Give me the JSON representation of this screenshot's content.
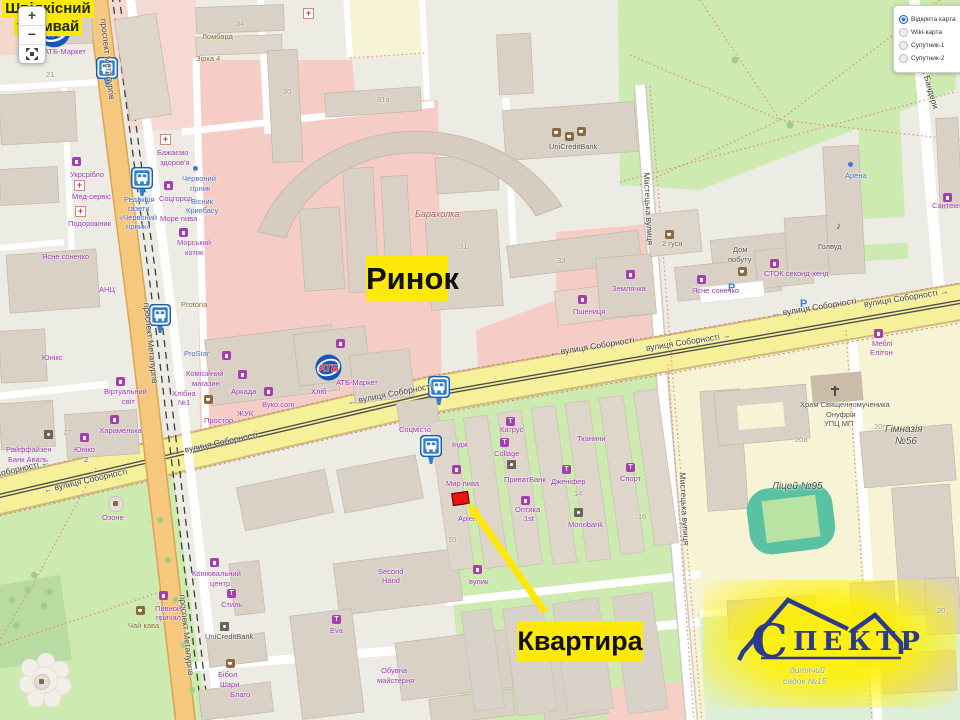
{
  "controls": {
    "zoom_in": "+",
    "zoom_out": "−"
  },
  "layers": {
    "options": [
      {
        "label": "Відкрита карта",
        "selected": true
      },
      {
        "label": "Wiki-карта",
        "selected": false
      },
      {
        "label": "Супутник-1",
        "selected": false
      },
      {
        "label": "Супутник-2",
        "selected": false
      }
    ]
  },
  "annotations": {
    "market": "Ринок",
    "apartment": "Квартира",
    "tram_line1": "Швідкісний",
    "tram_line2": "трамвай"
  },
  "logo": {
    "initial": "С",
    "rest": "ПЕКТР"
  },
  "colors": {
    "annotation_bg": "#ffe90a",
    "marker_red": "#ee1212",
    "street_major": "#f6f09b",
    "street_avenue": "#f6c87e",
    "park": "#cdeab0",
    "market_zone": "#f6cdc6",
    "school_zone": "#f7f4d6"
  },
  "map_labels": [
    {
      "t": "вулиця Соборності ←",
      "x": -34,
      "y": 477,
      "c": "street",
      "r": -13
    },
    {
      "t": "← вулиця Соборності",
      "x": 44,
      "y": 486,
      "c": "street",
      "r": -13
    },
    {
      "t": "← вулиця Соборності",
      "x": 174,
      "y": 448,
      "c": "street",
      "r": -12
    },
    {
      "t": "← вулиця Соборності",
      "x": 348,
      "y": 398,
      "c": "street",
      "r": -11
    },
    {
      "t": "← вулиця Соборності",
      "x": 550,
      "y": 349,
      "c": "street",
      "r": -9
    },
    {
      "t": "вулиця Соборності →",
      "x": 646,
      "y": 344,
      "c": "street",
      "r": -9
    },
    {
      "t": "← вулиця Соборності",
      "x": 772,
      "y": 310,
      "c": "street",
      "r": -9
    },
    {
      "t": "вулиця Соборності →",
      "x": 864,
      "y": 300,
      "c": "street",
      "r": -9
    },
    {
      "t": "проспект Металургів",
      "x": 103,
      "y": 14,
      "c": "street",
      "r": 84
    },
    {
      "t": "проспект Металургів",
      "x": 146,
      "y": 298,
      "c": "street",
      "r": 84
    },
    {
      "t": "проспект Металургів",
      "x": 182,
      "y": 590,
      "c": "street",
      "r": 84
    },
    {
      "t": "Мистецька вулиця",
      "x": 646,
      "y": 168,
      "c": "street",
      "r": 87
    },
    {
      "t": "Мистецька вулиця",
      "x": 682,
      "y": 468,
      "c": "street",
      "r": 87
    },
    {
      "t": "вулиця Степана Бандери",
      "x": 908,
      "y": 8,
      "c": "street",
      "r": 74
    },
    {
      "t": "Альфа-",
      "x": 48,
      "y": 6,
      "c": "shop"
    },
    {
      "t": "АТБ-Маркет",
      "x": 44,
      "y": 48,
      "c": "shop"
    },
    {
      "t": "Ломбард",
      "x": 202,
      "y": 33,
      "c": "amen"
    },
    {
      "t": "Зірка 4",
      "x": 196,
      "y": 55,
      "c": "amen"
    },
    {
      "t": "Бажаємо",
      "x": 157,
      "y": 149,
      "c": "shop"
    },
    {
      "t": "здоров'я",
      "x": 160,
      "y": 159,
      "c": "shop"
    },
    {
      "t": "Укрсрібло",
      "x": 70,
      "y": 171,
      "c": "shop"
    },
    {
      "t": "Мед-сервіс",
      "x": 72,
      "y": 193,
      "c": "shop"
    },
    {
      "t": "Подорожник",
      "x": 68,
      "y": 220,
      "c": "shop"
    },
    {
      "t": "Червоний",
      "x": 182,
      "y": 175,
      "c": "info"
    },
    {
      "t": "гірник",
      "x": 190,
      "y": 185,
      "c": "info"
    },
    {
      "t": "Редакція",
      "x": 124,
      "y": 196,
      "c": "info"
    },
    {
      "t": "газети",
      "x": 128,
      "y": 205,
      "c": "info"
    },
    {
      "t": "«Червоний",
      "x": 119,
      "y": 214,
      "c": "info"
    },
    {
      "t": "гірник»",
      "x": 126,
      "y": 223,
      "c": "info"
    },
    {
      "t": "Соцгород",
      "x": 159,
      "y": 195,
      "c": "shop"
    },
    {
      "t": "Море пива",
      "x": 160,
      "y": 215,
      "c": "shop"
    },
    {
      "t": "Вісник",
      "x": 191,
      "y": 198,
      "c": "info"
    },
    {
      "t": "Кривбасу",
      "x": 186,
      "y": 207,
      "c": "info"
    },
    {
      "t": "Морський",
      "x": 177,
      "y": 239,
      "c": "shop"
    },
    {
      "t": "котик",
      "x": 185,
      "y": 249,
      "c": "shop"
    },
    {
      "t": "Ясне сонечко",
      "x": 42,
      "y": 253,
      "c": "shop"
    },
    {
      "t": "АНЦ",
      "x": 99,
      "y": 286,
      "c": "shop"
    },
    {
      "t": "Protoria",
      "x": 181,
      "y": 301,
      "c": "amen"
    },
    {
      "t": "Юнікс",
      "x": 42,
      "y": 354,
      "c": "shop"
    },
    {
      "t": "Райффайзен",
      "x": 6,
      "y": 446,
      "c": "shop"
    },
    {
      "t": "Банк Аваль",
      "x": 8,
      "y": 456,
      "c": "shop"
    },
    {
      "t": "Віртуальний",
      "x": 104,
      "y": 388,
      "c": "shop"
    },
    {
      "t": "світ",
      "x": 122,
      "y": 398,
      "c": "shop"
    },
    {
      "t": "Карамелька",
      "x": 100,
      "y": 427,
      "c": "shop"
    },
    {
      "t": "Хлібна",
      "x": 172,
      "y": 390,
      "c": "shop"
    },
    {
      "t": "№1",
      "x": 178,
      "y": 399,
      "c": "shop"
    },
    {
      "t": "Юніко",
      "x": 74,
      "y": 446,
      "c": "shop"
    },
    {
      "t": "2",
      "x": 84,
      "y": 456,
      "c": "shop"
    },
    {
      "t": "Озоне",
      "x": 102,
      "y": 514,
      "c": "shop"
    },
    {
      "t": "ProStar",
      "x": 184,
      "y": 350,
      "c": "info"
    },
    {
      "t": "Комісійний",
      "x": 186,
      "y": 370,
      "c": "shop"
    },
    {
      "t": "магазин",
      "x": 192,
      "y": 380,
      "c": "shop"
    },
    {
      "t": "Аркада",
      "x": 231,
      "y": 388,
      "c": "shop"
    },
    {
      "t": "ЖУК",
      "x": 237,
      "y": 410,
      "c": "shop"
    },
    {
      "t": "Вуко.com",
      "x": 262,
      "y": 401,
      "c": "shop"
    },
    {
      "t": "Простор",
      "x": 204,
      "y": 417,
      "c": "shop"
    },
    {
      "t": "Хліб",
      "x": 311,
      "y": 388,
      "c": "shop"
    },
    {
      "t": "АТБ-Маркет",
      "x": 336,
      "y": 379,
      "c": "shop"
    },
    {
      "t": "Соцмісто",
      "x": 399,
      "y": 426,
      "c": "shop"
    },
    {
      "t": "Барахолка",
      "x": 415,
      "y": 210,
      "c": "bara"
    },
    {
      "t": "UniCreditBank",
      "x": 549,
      "y": 143,
      "c": "poi"
    },
    {
      "t": "2 гуся",
      "x": 662,
      "y": 240,
      "c": "amen"
    },
    {
      "t": "Землячка",
      "x": 612,
      "y": 285,
      "c": "shop"
    },
    {
      "t": "Пшениця",
      "x": 573,
      "y": 308,
      "c": "shop"
    },
    {
      "t": "Ясне сонечко",
      "x": 692,
      "y": 287,
      "c": "shop"
    },
    {
      "t": "Дом",
      "x": 733,
      "y": 246,
      "c": "poi"
    },
    {
      "t": "побуту",
      "x": 728,
      "y": 256,
      "c": "poi"
    },
    {
      "t": "СТОК секонд-хенд",
      "x": 764,
      "y": 270,
      "c": "shop"
    },
    {
      "t": "Арена",
      "x": 845,
      "y": 172,
      "c": "info"
    },
    {
      "t": "Голвуд",
      "x": 818,
      "y": 243,
      "c": "poi"
    },
    {
      "t": "Сантехніка",
      "x": 932,
      "y": 202,
      "c": "shop"
    },
    {
      "t": "Меблі",
      "x": 872,
      "y": 340,
      "c": "shop"
    },
    {
      "t": "Елітон",
      "x": 870,
      "y": 349,
      "c": "shop"
    },
    {
      "t": "Храм Священномученика",
      "x": 800,
      "y": 401,
      "c": "poi"
    },
    {
      "t": "Онуфрія",
      "x": 826,
      "y": 411,
      "c": "poi"
    },
    {
      "t": "УПЦ МП",
      "x": 824,
      "y": 420,
      "c": "poi"
    },
    {
      "t": "Гімназія",
      "x": 885,
      "y": 424,
      "c": "place"
    },
    {
      "t": "№56",
      "x": 895,
      "y": 436,
      "c": "place"
    },
    {
      "t": "Ліцей №95",
      "x": 772,
      "y": 481,
      "c": "place"
    },
    {
      "t": "Індж",
      "x": 452,
      "y": 441,
      "c": "shop"
    },
    {
      "t": "Катрус",
      "x": 500,
      "y": 426,
      "c": "shop"
    },
    {
      "t": "Collage",
      "x": 494,
      "y": 450,
      "c": "shop"
    },
    {
      "t": "Тканини",
      "x": 577,
      "y": 435,
      "c": "shop"
    },
    {
      "t": "Мир пива",
      "x": 446,
      "y": 480,
      "c": "shop"
    },
    {
      "t": "ПриватБанк",
      "x": 504,
      "y": 476,
      "c": "shop"
    },
    {
      "t": "Дженіфер",
      "x": 551,
      "y": 478,
      "c": "shop"
    },
    {
      "t": "Спорт",
      "x": 620,
      "y": 475,
      "c": "shop"
    },
    {
      "t": "Аріель",
      "x": 458,
      "y": 515,
      "c": "shop"
    },
    {
      "t": "Оптика",
      "x": 515,
      "y": 506,
      "c": "shop"
    },
    {
      "t": "1st",
      "x": 524,
      "y": 515,
      "c": "shop"
    },
    {
      "t": "Monobank",
      "x": 568,
      "y": 521,
      "c": "shop"
    },
    {
      "t": "вулик",
      "x": 469,
      "y": 578,
      "c": "shop"
    },
    {
      "t": "Second",
      "x": 378,
      "y": 568,
      "c": "shop"
    },
    {
      "t": "Hand",
      "x": 382,
      "y": 577,
      "c": "shop"
    },
    {
      "t": "Пивной",
      "x": 155,
      "y": 605,
      "c": "shop"
    },
    {
      "t": "причал",
      "x": 156,
      "y": 614,
      "c": "shop"
    },
    {
      "t": "Чай кава",
      "x": 128,
      "y": 622,
      "c": "amen"
    },
    {
      "t": "Копіювальний",
      "x": 192,
      "y": 570,
      "c": "shop"
    },
    {
      "t": "центр",
      "x": 210,
      "y": 580,
      "c": "shop"
    },
    {
      "t": "Стиль",
      "x": 221,
      "y": 601,
      "c": "shop"
    },
    {
      "t": "UniCreditBank",
      "x": 205,
      "y": 633,
      "c": "poi"
    },
    {
      "t": "Бібол",
      "x": 218,
      "y": 671,
      "c": "shop"
    },
    {
      "t": "Шари",
      "x": 220,
      "y": 681,
      "c": "shop"
    },
    {
      "t": "Благо",
      "x": 230,
      "y": 691,
      "c": "shop"
    },
    {
      "t": "Eva",
      "x": 330,
      "y": 627,
      "c": "shop"
    },
    {
      "t": "Обувна",
      "x": 381,
      "y": 667,
      "c": "shop"
    },
    {
      "t": "майстерня",
      "x": 377,
      "y": 677,
      "c": "shop"
    },
    {
      "t": "дитячий",
      "x": 790,
      "y": 666,
      "c": "nat"
    },
    {
      "t": "садок №15",
      "x": 783,
      "y": 677,
      "c": "nat"
    },
    {
      "t": "34",
      "x": 236,
      "y": 20,
      "c": "num"
    },
    {
      "t": "21",
      "x": 46,
      "y": 71,
      "c": "num"
    },
    {
      "t": "30",
      "x": 283,
      "y": 88,
      "c": "num"
    },
    {
      "t": "31a",
      "x": 377,
      "y": 96,
      "c": "num"
    },
    {
      "t": "31",
      "x": 459,
      "y": 243,
      "c": "num"
    },
    {
      "t": "33",
      "x": 557,
      "y": 257,
      "c": "num"
    },
    {
      "t": "27",
      "x": 63,
      "y": 429,
      "c": "num"
    },
    {
      "t": "14",
      "x": 574,
      "y": 490,
      "c": "num"
    },
    {
      "t": "16",
      "x": 638,
      "y": 513,
      "c": "num"
    },
    {
      "t": "10",
      "x": 448,
      "y": 536,
      "c": "num"
    },
    {
      "t": "20г",
      "x": 874,
      "y": 423,
      "c": "num"
    },
    {
      "t": "20а",
      "x": 795,
      "y": 436,
      "c": "num"
    },
    {
      "t": "20",
      "x": 937,
      "y": 607,
      "c": "num"
    }
  ],
  "map_icons": [
    {
      "k": "atb",
      "x": 37,
      "y": 14,
      "s": 34,
      "t": "АТБ"
    },
    {
      "k": "atb",
      "x": 315,
      "y": 354,
      "s": 27,
      "t": "АТБ"
    },
    {
      "k": "bus",
      "x": 96,
      "y": 57
    },
    {
      "k": "bus",
      "x": 131,
      "y": 167
    },
    {
      "k": "bus",
      "x": 149,
      "y": 304
    },
    {
      "k": "bus",
      "x": 428,
      "y": 376
    },
    {
      "k": "bus",
      "x": 420,
      "y": 435
    },
    {
      "k": "p",
      "x": 728,
      "y": 283,
      "t": "P"
    },
    {
      "k": "p",
      "x": 800,
      "y": 299,
      "t": "P"
    },
    {
      "k": "pharmacy",
      "x": 303,
      "y": 8
    },
    {
      "k": "pharmacy",
      "x": 160,
      "y": 134
    },
    {
      "k": "pharmacy",
      "x": 74,
      "y": 180
    },
    {
      "k": "pharmacy",
      "x": 75,
      "y": 206
    },
    {
      "k": "shop",
      "x": 72,
      "y": 157
    },
    {
      "k": "shop",
      "x": 164,
      "y": 181
    },
    {
      "k": "shop",
      "x": 179,
      "y": 228
    },
    {
      "k": "shop",
      "x": 222,
      "y": 351
    },
    {
      "k": "shop",
      "x": 238,
      "y": 370
    },
    {
      "k": "shop",
      "x": 264,
      "y": 387
    },
    {
      "k": "shop",
      "x": 336,
      "y": 339
    },
    {
      "k": "shop",
      "x": 452,
      "y": 465
    },
    {
      "k": "shop",
      "x": 473,
      "y": 565
    },
    {
      "k": "shop",
      "x": 159,
      "y": 591
    },
    {
      "k": "shop",
      "x": 210,
      "y": 558
    },
    {
      "k": "shop",
      "x": 116,
      "y": 377
    },
    {
      "k": "shop",
      "x": 80,
      "y": 433
    },
    {
      "k": "shop",
      "x": 110,
      "y": 415
    },
    {
      "k": "shop",
      "x": 626,
      "y": 270
    },
    {
      "k": "shop",
      "x": 578,
      "y": 295
    },
    {
      "k": "shop",
      "x": 697,
      "y": 275
    },
    {
      "k": "shop",
      "x": 770,
      "y": 259
    },
    {
      "k": "shop",
      "x": 943,
      "y": 193
    },
    {
      "k": "shop",
      "x": 874,
      "y": 329
    },
    {
      "k": "shop",
      "x": 521,
      "y": 496
    },
    {
      "k": "cafe",
      "x": 204,
      "y": 395
    },
    {
      "k": "cafe",
      "x": 136,
      "y": 606
    },
    {
      "k": "cafe",
      "x": 552,
      "y": 128
    },
    {
      "k": "cafe",
      "x": 565,
      "y": 132
    },
    {
      "k": "cafe",
      "x": 577,
      "y": 127
    },
    {
      "k": "cafe",
      "x": 665,
      "y": 230
    },
    {
      "k": "cafe",
      "x": 738,
      "y": 267
    },
    {
      "k": "cafe",
      "x": 226,
      "y": 659
    },
    {
      "k": "clothes",
      "x": 562,
      "y": 465
    },
    {
      "k": "clothes",
      "x": 626,
      "y": 463
    },
    {
      "k": "clothes",
      "x": 500,
      "y": 438
    },
    {
      "k": "clothes",
      "x": 506,
      "y": 417
    },
    {
      "k": "clothes",
      "x": 332,
      "y": 615
    },
    {
      "k": "clothes",
      "x": 227,
      "y": 589
    },
    {
      "k": "bank",
      "x": 507,
      "y": 460
    },
    {
      "k": "bank",
      "x": 574,
      "y": 508
    },
    {
      "k": "bank",
      "x": 220,
      "y": 622
    },
    {
      "k": "bank",
      "x": 44,
      "y": 430
    },
    {
      "k": "dot",
      "x": 193,
      "y": 166
    },
    {
      "k": "dot",
      "x": 848,
      "y": 162
    },
    {
      "k": "music",
      "x": 836,
      "y": 222,
      "t": "♪"
    },
    {
      "k": "cross",
      "x": 834,
      "y": 386
    },
    {
      "k": "fountain",
      "x": 108,
      "y": 496
    },
    {
      "k": "fountain",
      "x": 34,
      "y": 674
    }
  ]
}
